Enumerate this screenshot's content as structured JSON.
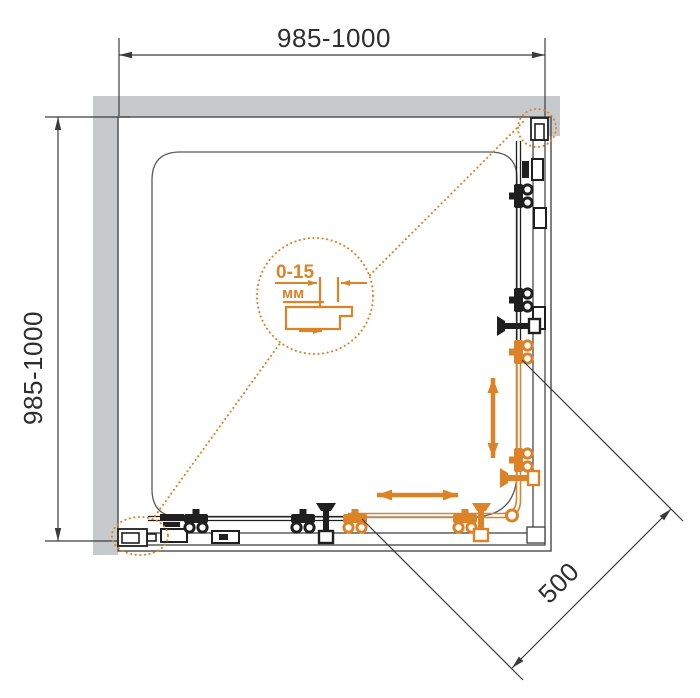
{
  "title": "Corner shower enclosure — plan view technical drawing",
  "colors": {
    "accent_orange": "#DC8328",
    "wall_gray": "#C6CACD",
    "line_black": "#3B3B3B"
  },
  "dimensions": {
    "top_width": "985-1000",
    "left_depth": "985-1000",
    "diagonal_entry": "500",
    "adjustment_range": "0-15",
    "adjustment_unit": "мм"
  }
}
